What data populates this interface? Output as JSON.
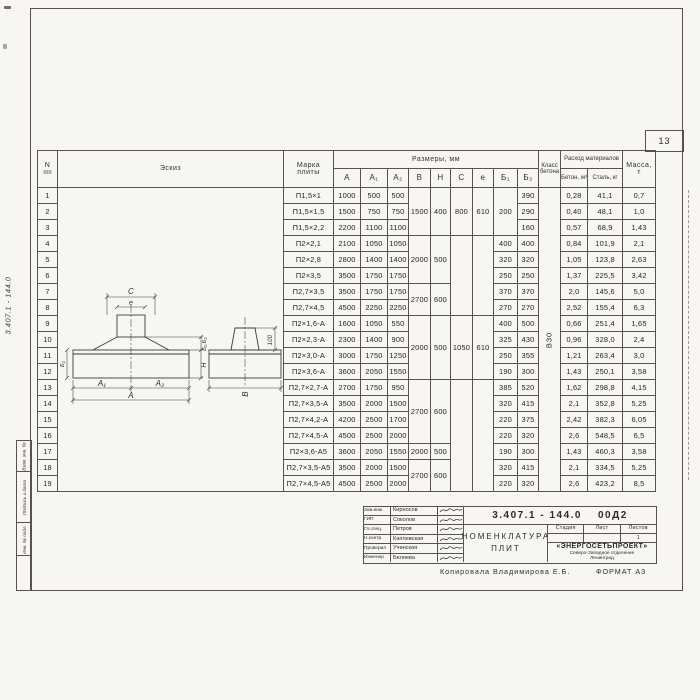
{
  "page": {
    "number": "13"
  },
  "margins": {
    "doc_number_vertical": "3.407.1 - 144.0",
    "boxes": [
      "Взам. инв. №",
      "Подпись и дата",
      "Инв. № подл."
    ]
  },
  "table": {
    "header": {
      "n_line1": "N",
      "n_line2": "п/п",
      "sketch": "Эскиз",
      "mark_line1": "Марка",
      "mark_line2": "плиты",
      "sizes": "Размеры,  мм",
      "size_cols": [
        "А",
        "А₁",
        "А₂",
        "В",
        "Н",
        "С",
        "е",
        "Б₁",
        "Б₂"
      ],
      "klass_line1": "Класс",
      "klass_line2": "бетона",
      "consumption": "Расход материалов",
      "consumption_cols": [
        "Бетон, м³",
        "Сталь, кг"
      ],
      "mass_line1": "Масса,",
      "mass_line2": "т"
    },
    "merges": {
      "b": [
        [
          1,
          3,
          "1500"
        ],
        [
          4,
          3,
          "2000"
        ],
        [
          7,
          2,
          "2700"
        ],
        [
          9,
          4,
          "2000"
        ],
        [
          13,
          4,
          "2700"
        ],
        [
          17,
          1,
          "2000"
        ],
        [
          18,
          2,
          "2700"
        ]
      ],
      "h": [
        [
          1,
          3,
          "400"
        ],
        [
          4,
          3,
          "500"
        ],
        [
          7,
          2,
          "600"
        ],
        [
          9,
          4,
          "500"
        ],
        [
          13,
          4,
          "600"
        ],
        [
          17,
          1,
          "500"
        ],
        [
          18,
          2,
          "600"
        ]
      ],
      "c": [
        [
          1,
          3,
          "800"
        ],
        [
          4,
          5,
          ""
        ],
        [
          9,
          4,
          "1050"
        ],
        [
          13,
          7,
          ""
        ]
      ],
      "e": [
        [
          1,
          3,
          "610"
        ],
        [
          4,
          5,
          ""
        ],
        [
          9,
          4,
          "610"
        ],
        [
          13,
          7,
          ""
        ]
      ],
      "b1": [
        [
          1,
          3,
          "200"
        ]
      ],
      "klass": [
        [
          1,
          19,
          "В30"
        ]
      ]
    },
    "rows": [
      {
        "n": "1",
        "mark": "П1,5×1",
        "a": "1000",
        "a1": "500",
        "a2": "500",
        "b1": "",
        "b2": "390",
        "concrete": "0,28",
        "steel": "41,1",
        "mass": "0,7"
      },
      {
        "n": "2",
        "mark": "П1,5×1,5",
        "a": "1500",
        "a1": "750",
        "a2": "750",
        "b1": "",
        "b2": "290",
        "concrete": "0,40",
        "steel": "48,1",
        "mass": "1,0"
      },
      {
        "n": "3",
        "mark": "П1,5×2,2",
        "a": "2200",
        "a1": "1100",
        "a2": "1100",
        "b1": "",
        "b2": "160",
        "concrete": "0,57",
        "steel": "68,9",
        "mass": "1,43"
      },
      {
        "n": "4",
        "mark": "П2×2,1",
        "a": "2100",
        "a1": "1050",
        "a2": "1050",
        "b1": "400",
        "b2": "400",
        "concrete": "0,84",
        "steel": "101,9",
        "mass": "2,1"
      },
      {
        "n": "5",
        "mark": "П2×2,8",
        "a": "2800",
        "a1": "1400",
        "a2": "1400",
        "b1": "320",
        "b2": "320",
        "concrete": "1,05",
        "steel": "123,8",
        "mass": "2,63"
      },
      {
        "n": "6",
        "mark": "П2×3,5",
        "a": "3500",
        "a1": "1750",
        "a2": "1750",
        "b1": "250",
        "b2": "250",
        "concrete": "1,37",
        "steel": "225,5",
        "mass": "3,42"
      },
      {
        "n": "7",
        "mark": "П2,7×3,5",
        "a": "3500",
        "a1": "1750",
        "a2": "1750",
        "b1": "370",
        "b2": "370",
        "concrete": "2,0",
        "steel": "145,6",
        "mass": "5,0"
      },
      {
        "n": "8",
        "mark": "П2,7×4,5",
        "a": "4500",
        "a1": "2250",
        "a2": "2250",
        "b1": "270",
        "b2": "270",
        "concrete": "2,52",
        "steel": "155,4",
        "mass": "6,3"
      },
      {
        "n": "9",
        "mark": "П2×1,6-А",
        "a": "1600",
        "a1": "1050",
        "a2": "550",
        "b1": "400",
        "b2": "500",
        "concrete": "0,66",
        "steel": "251,4",
        "mass": "1,65"
      },
      {
        "n": "10",
        "mark": "П2×2,3-А",
        "a": "2300",
        "a1": "1400",
        "a2": "900",
        "b1": "325",
        "b2": "430",
        "concrete": "0,96",
        "steel": "328,0",
        "mass": "2,4"
      },
      {
        "n": "11",
        "mark": "П2×3,0-А",
        "a": "3000",
        "a1": "1750",
        "a2": "1250",
        "b1": "250",
        "b2": "355",
        "concrete": "1,21",
        "steel": "263,4",
        "mass": "3,0"
      },
      {
        "n": "12",
        "mark": "П2×3,6-А",
        "a": "3600",
        "a1": "2050",
        "a2": "1550",
        "b1": "190",
        "b2": "300",
        "concrete": "1,43",
        "steel": "250,1",
        "mass": "3,58"
      },
      {
        "n": "13",
        "mark": "П2,7×2,7-А",
        "a": "2700",
        "a1": "1750",
        "a2": "950",
        "b1": "385",
        "b2": "520",
        "concrete": "1,62",
        "steel": "298,8",
        "mass": "4,15"
      },
      {
        "n": "14",
        "mark": "П2,7×3,5-А",
        "a": "3500",
        "a1": "2000",
        "a2": "1500",
        "b1": "320",
        "b2": "415",
        "concrete": "2,1",
        "steel": "352,8",
        "mass": "5,25"
      },
      {
        "n": "15",
        "mark": "П2,7×4,2-А",
        "a": "4200",
        "a1": "2500",
        "a2": "1700",
        "b1": "220",
        "b2": "375",
        "concrete": "2,42",
        "steel": "382,3",
        "mass": "6,05"
      },
      {
        "n": "16",
        "mark": "П2,7×4,5-А",
        "a": "4500",
        "a1": "2500",
        "a2": "2000",
        "b1": "220",
        "b2": "320",
        "concrete": "2,6",
        "steel": "548,5",
        "mass": "6,5"
      },
      {
        "n": "17",
        "mark": "П2×3,6-А5",
        "a": "3600",
        "a1": "2050",
        "a2": "1550",
        "b1": "190",
        "b2": "300",
        "concrete": "1,43",
        "steel": "460,3",
        "mass": "3,58"
      },
      {
        "n": "18",
        "mark": "П2,7×3,5-А5",
        "a": "3500",
        "a1": "2000",
        "a2": "1500",
        "b1": "320",
        "b2": "415",
        "concrete": "2,1",
        "steel": "334,5",
        "mass": "5,25"
      },
      {
        "n": "19",
        "mark": "П2,7×4,5-А5",
        "a": "4500",
        "a1": "2500",
        "a2": "2000",
        "b1": "220",
        "b2": "320",
        "concrete": "2,6",
        "steel": "423,2",
        "mass": "8,5"
      }
    ]
  },
  "sketch": {
    "dim_c": "С",
    "dim_e": "е",
    "dim_a1": "А₁",
    "dim_a2": "А₂",
    "dim_a": "А",
    "dim_b12": "Б₁,Б₂",
    "dim_h": "Н",
    "dim_left": "Б₂",
    "dim_b": "В",
    "dim_100": "100"
  },
  "titleblock": {
    "doc_number": "3.407.1 - 144.0",
    "doc_sheet": "00Д2",
    "staff": [
      {
        "role": "Зав.инж.",
        "name": "Кирносов"
      },
      {
        "role": "ГИП",
        "name": "Соколов"
      },
      {
        "role": "Гл.спец.",
        "name": "Петров"
      },
      {
        "role": "Н.контр.",
        "name": "Каплевская"
      },
      {
        "role": "Проверил",
        "name": "Учинская"
      },
      {
        "role": "Инженер",
        "name": "Беляева"
      }
    ],
    "title_line1": "НОМЕНКЛАТУРА",
    "title_line2": "ПЛИТ",
    "stage_cols": [
      "Стадия",
      "Лист",
      "Листов"
    ],
    "stage_values": [
      "",
      "",
      "1"
    ],
    "org_line1": "«ЭНЕРГОСЕТЬПРОЕКТ»",
    "org_line2": "Северо-Западное отделение",
    "org_line3": "Ленинград"
  },
  "footer": {
    "copied": "Копировала  Владимирова Е.Б.",
    "format": "ФОРМАТ А3"
  }
}
